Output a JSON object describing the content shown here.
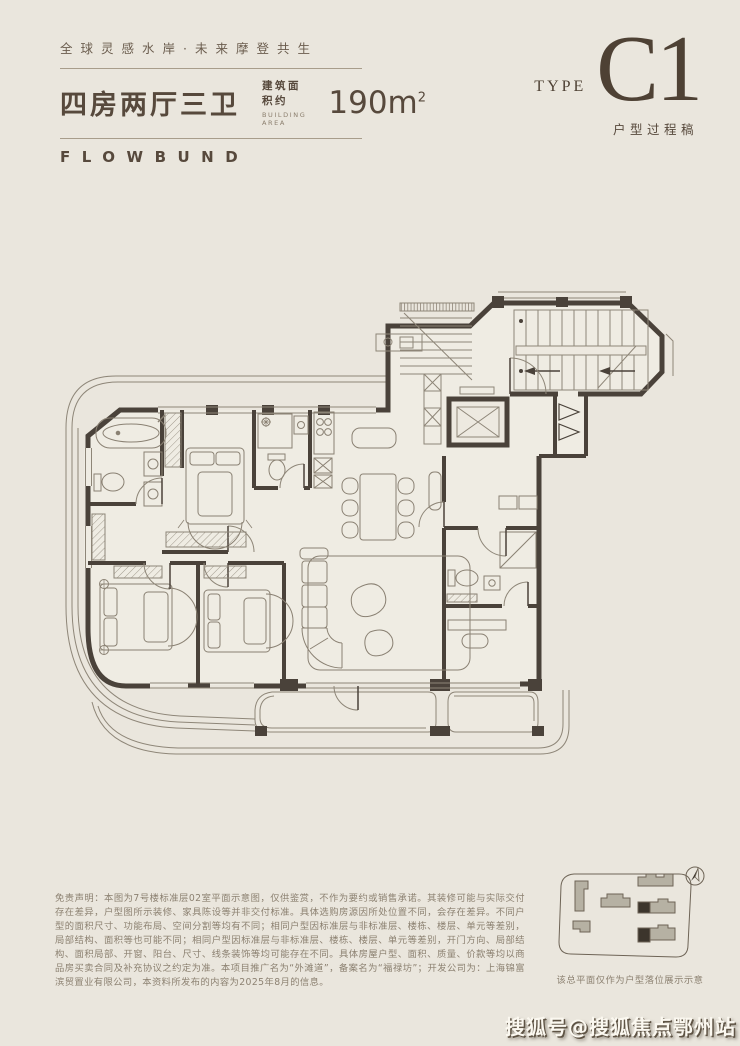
{
  "page": {
    "background": "#EAE6DD",
    "ink": "#57493C",
    "wall_color": "#4A423A",
    "muted": "#8C8171",
    "rule_color": "#A89D8B"
  },
  "header": {
    "tagline": "全球灵感水岸·未来摩登共生",
    "unit_title": "四房两厅三卫",
    "area_label_cn": "建筑面积约",
    "area_label_en": "BUILDING AREA",
    "area_value": "190m",
    "area_superscript": "2",
    "brand": "FLOWBUND"
  },
  "type_badge": {
    "label": "TYPE",
    "value": "C1",
    "note": "户型过程稿"
  },
  "disclaimer": {
    "text": "免责声明：本图为7号楼标准层02室平面示意图，仅供鉴赏，不作为要约或销售承诺。其装修可能与实际交付存在差异，户型图所示装修、家具陈设等并非交付标准。具体选购房源因所处位置不同，会存在差异。不同户型的面积尺寸、功能布局、空间分割等均有不同；相同户型因标准层与非标准层、楼栋、楼层、单元等差别，局部结构、面积等也可能不同；相同户型因标准层与非标准层、楼栋、楼层、单元等差别，开门方向、局部结构、面积局部、开窗、阳台、尺寸、线条装饰等均可能存在不同。具体房屋户型、面积、质量、价款等均以商品房买卖合同及补充协议之约定为准。本项目推广名为“外滩道”，备案名为“福禄坊”；开发公司为：上海锦富滨贸置业有限公司，本资料所发布的内容为2025年8月的信息。"
  },
  "site_plan": {
    "caption": "该总平面仅作为户型落位展示示意"
  },
  "watermark": {
    "text": "搜狐号@搜狐焦点鄂州站"
  }
}
